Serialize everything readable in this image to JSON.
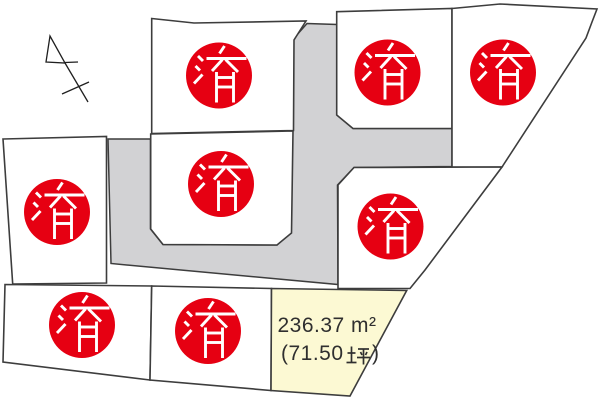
{
  "map": {
    "type": "land-subdivision-lot-map",
    "colors": {
      "road": "#d2d2d4",
      "lot_fill": "#ffffff",
      "available_lot_fill": "#fcf9d3",
      "outline": "#3d3d3d",
      "stamp_red": "#e60012",
      "stamp_text": "#ffffff",
      "label_text": "#2f2f2f"
    },
    "sold_stamp": {
      "character": "済",
      "meaning": "sold"
    },
    "lots": [
      {
        "position": "upper-middle",
        "status": "sold",
        "stamp": "済"
      },
      {
        "position": "middle",
        "status": "sold",
        "stamp": "済"
      },
      {
        "position": "upper-right-1",
        "status": "sold",
        "stamp": "済"
      },
      {
        "position": "upper-right-2",
        "status": "sold",
        "stamp": "済"
      },
      {
        "position": "middle-right",
        "status": "sold",
        "stamp": "済"
      },
      {
        "position": "left",
        "status": "sold",
        "stamp": "済"
      },
      {
        "position": "bottom-left",
        "status": "sold",
        "stamp": "済"
      },
      {
        "position": "bottom-middle",
        "status": "sold",
        "stamp": "済"
      },
      {
        "position": "bottom-right",
        "status": "available",
        "area_m2": "236.37 ㎡",
        "area_tsubo": "71.50 坪"
      }
    ],
    "available_label": {
      "line1_original": "236.37 ㎡",
      "line1_display": "236.37 m²",
      "line2_original": "（71.50 坪）",
      "line2_display_prefix": "(71.50",
      "line2_unit": "坪",
      "line2_display_suffix": ")"
    }
  }
}
